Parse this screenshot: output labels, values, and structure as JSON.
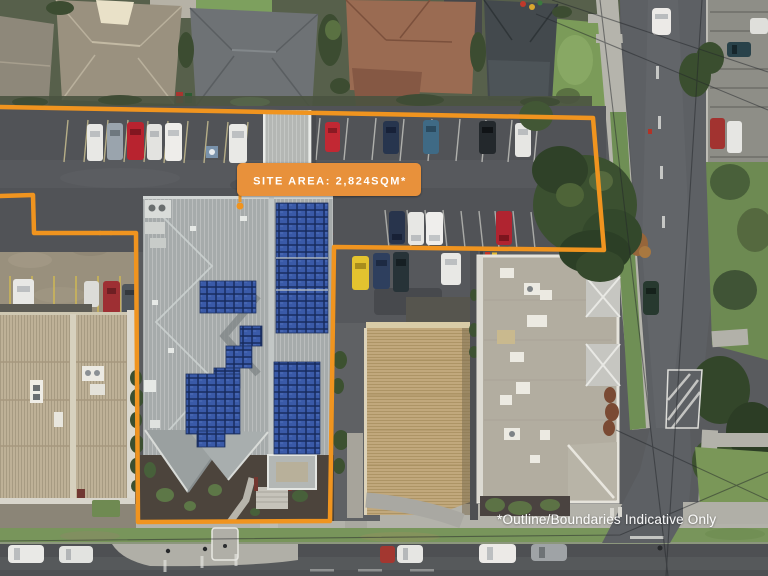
{
  "overlay": {
    "site_area_label": "SITE AREA: 2,824SQM*",
    "disclaimer": "*Outline/Boundaries Indicative Only"
  },
  "colors": {
    "boundary_orange": "#F0941F",
    "badge_background": "#E8913A",
    "badge_text": "#FFFFFF",
    "disclaimer_text": "#FFFFFF"
  }
}
